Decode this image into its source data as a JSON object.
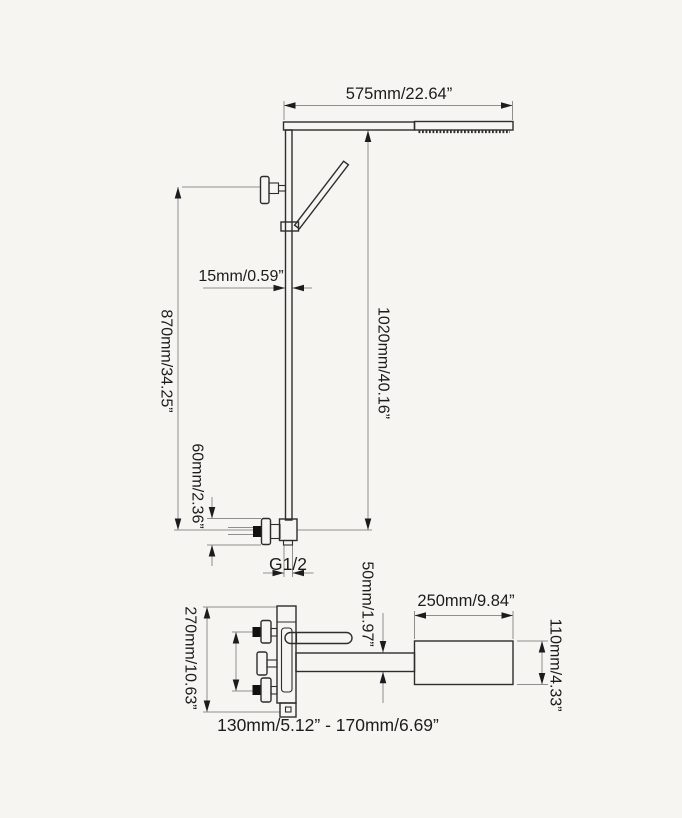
{
  "colors": {
    "background": "#f6f5f2",
    "outline": "#2d2d2d",
    "dimension": "#8f8f8f",
    "text": "#1c1c1c",
    "fill_black": "#111111"
  },
  "upper_view": {
    "dimensions": {
      "arm_length": "575mm/22.64”",
      "pipe_width": "15mm/0.59”",
      "bracket_height": "870mm/34.25”",
      "column_height": "1020mm/40.16”",
      "union_size": "60mm/2.36”",
      "thread_size": "G1/2"
    }
  },
  "lower_view": {
    "dimensions": {
      "spout_thickness": "50mm/1.97”",
      "spout_head_length": "250mm/9.84”",
      "body_height": "270mm/10.63”",
      "spout_head_width": "110mm/4.33”",
      "inlet_spacing_range": "130mm/5.12” - 170mm/6.69”"
    }
  }
}
